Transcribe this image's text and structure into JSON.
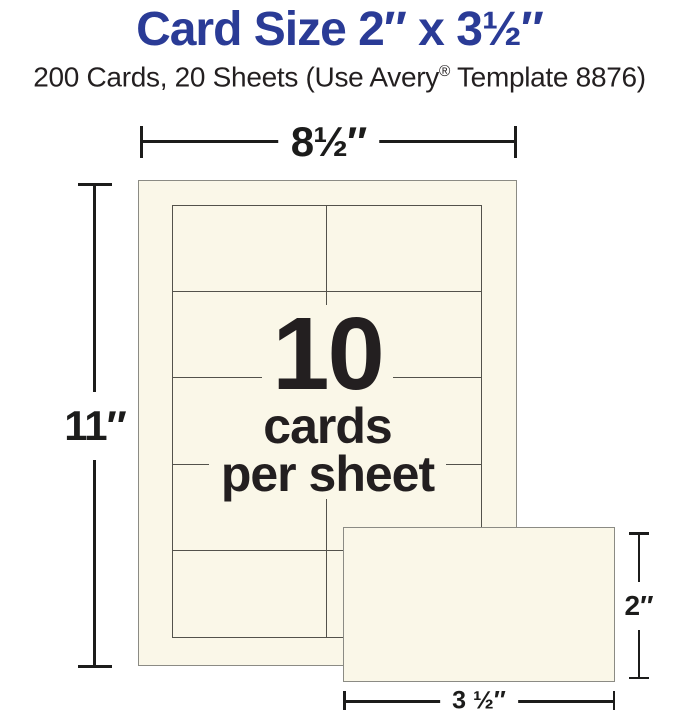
{
  "header": {
    "title": "Card Size 2″ x 3½″",
    "subtitle_pre": "200 Cards, 20 Sheets (Use Avery",
    "subtitle_reg_mark": "®",
    "subtitle_post": " Template 8876)"
  },
  "colors": {
    "title_blue": "#2a3b96",
    "text_dark": "#231f20",
    "sheet_fill": "#faf7e8",
    "sheet_border": "#8b8b84",
    "grid_line": "#53524b",
    "dimension_line": "#1c1c1b",
    "page_bg": "#ffffff"
  },
  "diagram": {
    "sheet": {
      "rows": 5,
      "cols": 2
    },
    "center_label": {
      "count": "10",
      "line2": "cards",
      "line3": "per sheet"
    },
    "dimensions": {
      "sheet_width": "8½″",
      "sheet_height": "11″",
      "card_height": "2″",
      "card_width": "3 ½″"
    }
  }
}
